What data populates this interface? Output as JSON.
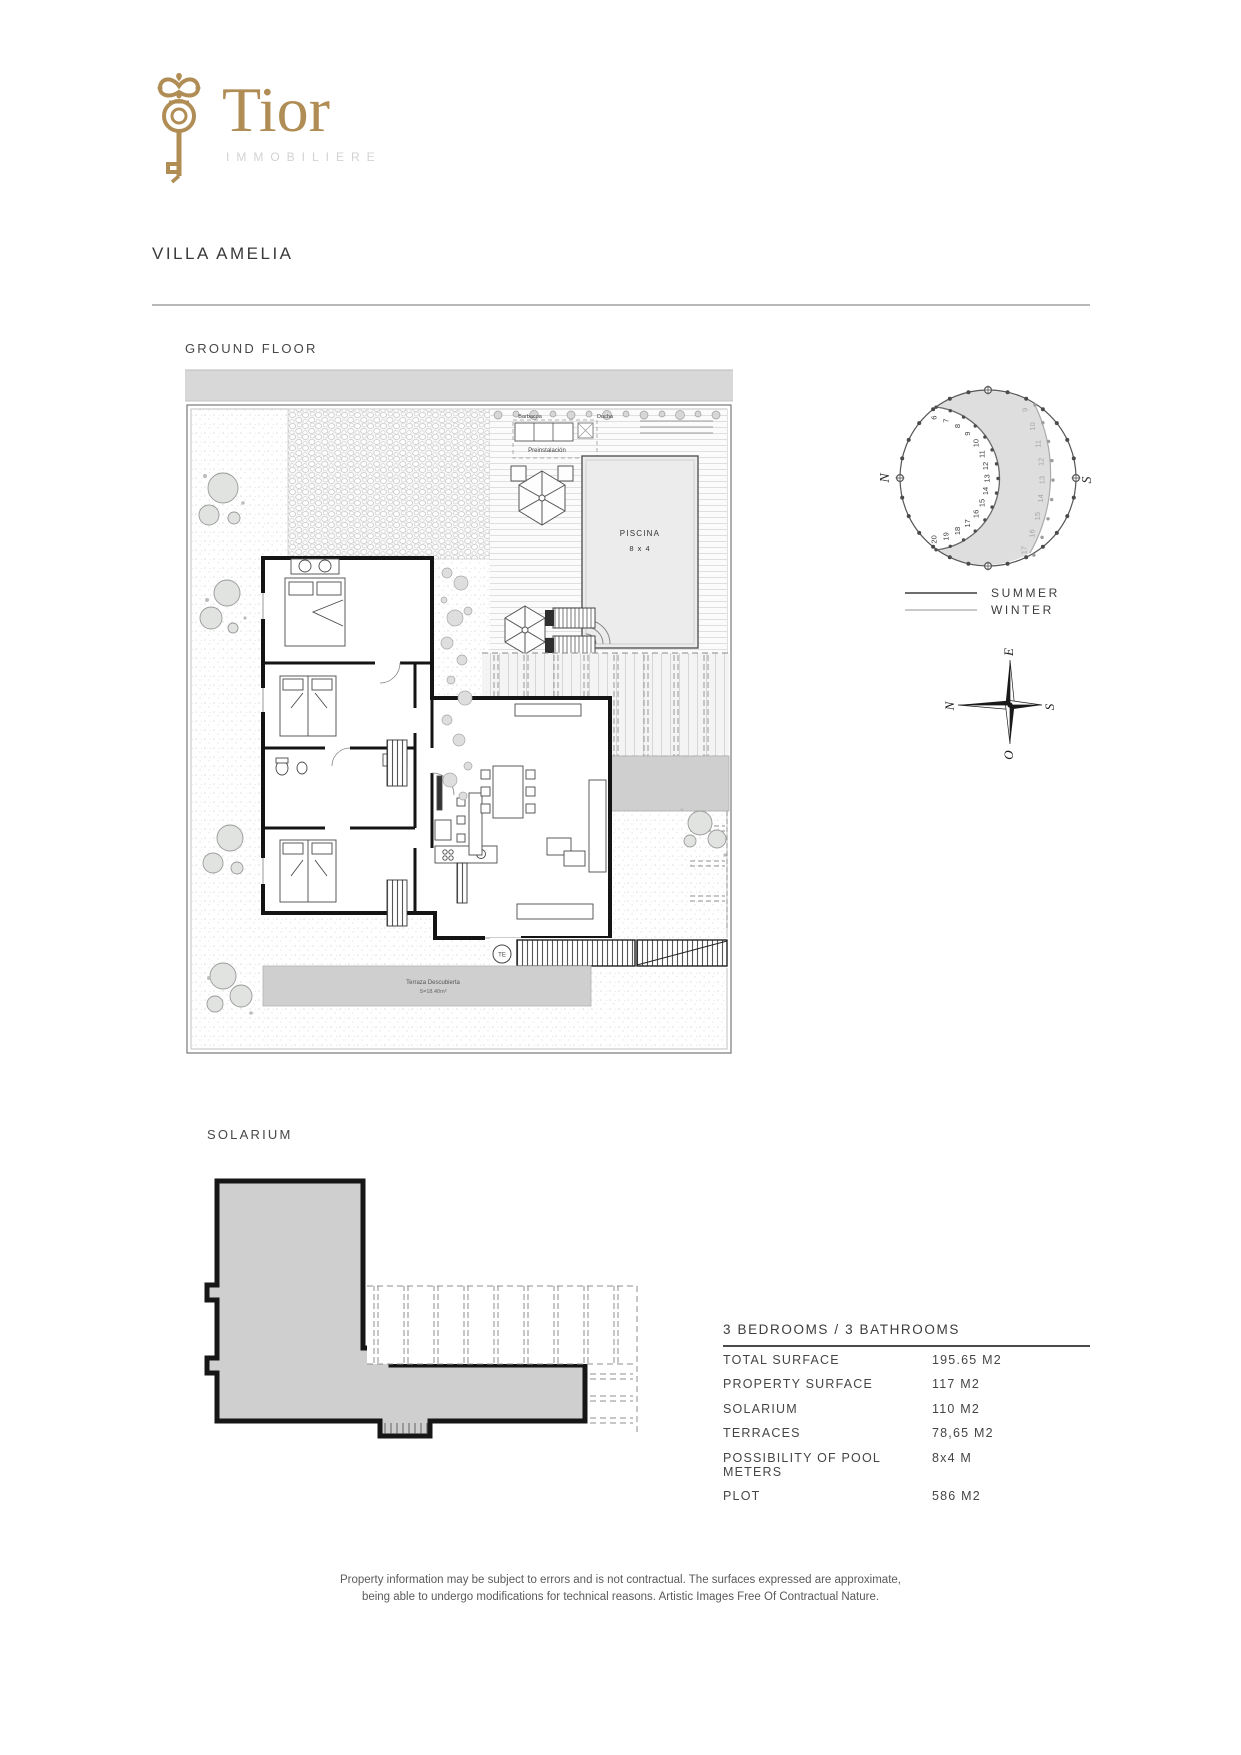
{
  "brand": {
    "name": "Tior",
    "subtitle": "IMMOBILIERE"
  },
  "page": {
    "title": "VILLA AMELIA"
  },
  "ground_floor": {
    "label": "GROUND FLOOR",
    "labels": {
      "barbacoa": "Barbacoa",
      "ducha": "Ducha",
      "preinstalacion": "Preinstalación",
      "piscina": "PISCINA",
      "piscina_size": "8 x 4",
      "terraza": "TERRAZA",
      "terraza_area": "S=48.15m²",
      "terraza_descubierta": "Terraza Descubierta",
      "terraza_descubierta_area": "S=18.40m²",
      "te": "TE",
      "tv": "TV"
    }
  },
  "sun_diagram": {
    "north": "N",
    "south": "S",
    "summer_hours": [
      "6",
      "7",
      "8",
      "9",
      "10",
      "11",
      "12",
      "13",
      "14",
      "15",
      "16",
      "17",
      "18",
      "19",
      "20"
    ],
    "winter_hours": [
      "9",
      "10",
      "11",
      "12",
      "13",
      "14",
      "15",
      "16",
      "17"
    ],
    "legend": {
      "summer": "SUMMER",
      "winter": "WINTER"
    }
  },
  "compass": {
    "e": "E",
    "n": "N",
    "s": "S",
    "o": "O"
  },
  "solarium": {
    "label": "SOLARIUM"
  },
  "specs": {
    "header": "3 BEDROOMS / 3 BATHROOMS",
    "rows": [
      {
        "label": "TOTAL SURFACE",
        "value": "195.65 M2"
      },
      {
        "label": "PROPERTY SURFACE",
        "value": "117 M2"
      },
      {
        "label": "SOLARIUM",
        "value": "110 M2"
      },
      {
        "label": "TERRACES",
        "value": "78,65 M2"
      },
      {
        "label": "POSSIBILITY OF POOL METERS",
        "value": "8x4 M"
      },
      {
        "label": "PLOT",
        "value": "586 M2"
      }
    ]
  },
  "footer": {
    "line1": "Property information may be subject to errors and is not contractual. The surfaces expressed are approximate,",
    "line2": "being able to undergo modifications for technical reasons. Artistic Images Free Of Contractual Nature."
  },
  "colors": {
    "gold": "#b08d55",
    "wall": "#141414",
    "fill_gray": "#cfcfcf",
    "band_gray": "#d8d8d8"
  }
}
